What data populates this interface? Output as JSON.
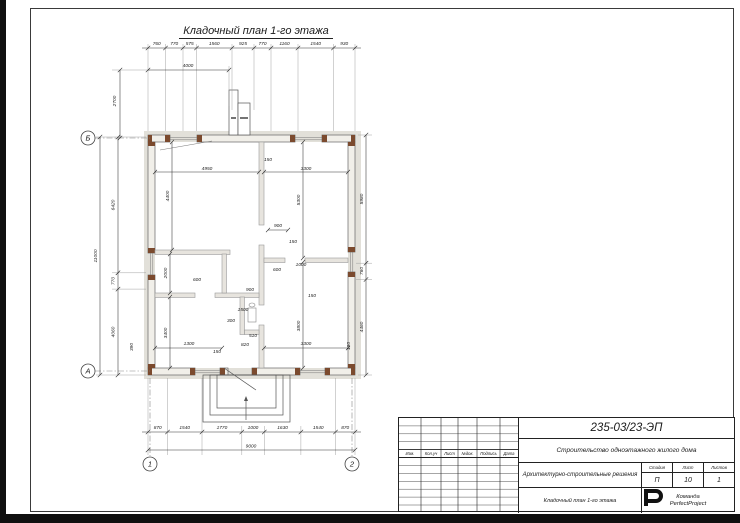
{
  "page": {
    "title": "Кладочный план 1-го этажа"
  },
  "plan": {
    "axis_markers": {
      "b": "Б",
      "a": "А",
      "n1": "1",
      "n2": "2"
    },
    "dims": {
      "top": [
        "760",
        "770",
        "575",
        "1560",
        "925",
        "770",
        "1160",
        "1540",
        "930"
      ],
      "top_secondary": "4000",
      "left_upper": "2700",
      "left": [
        "6420",
        "770",
        "4060"
      ],
      "left_overall": "11000",
      "left_small": "390",
      "right": [
        "5980",
        "760",
        "4460"
      ],
      "right_small": "180",
      "bottom": [
        "870",
        "1540",
        "1770",
        "1000",
        "1630",
        "1540",
        "870"
      ],
      "bottom_overall": "9000"
    },
    "interior": {
      "room_tl_width": "4950",
      "room_tl_height": "4400",
      "room_tr_width": "3300",
      "room_tr_height": "5300",
      "partition_top": "150",
      "door_right": "900",
      "partition_right": "150",
      "closet_height": "2000",
      "closet_width": "600",
      "hall_door": "900",
      "room_bl_height": "3400",
      "room_bl_width": "1300",
      "partition_bl": "150",
      "hall_width": "1500",
      "hall_depth": "300",
      "wc_width": "510",
      "wc_depth": "820",
      "room_br_width": "3300",
      "room_br_height": "3800",
      "niche_width": "600",
      "niche_depth": "1000",
      "partition_br": "150"
    }
  },
  "stamp": {
    "doc_number": "235-03/23-ЭП",
    "project_name": "Строительство одноэтажного жилого дома",
    "section_name": "Архитектурно-строительные решения",
    "sheet_name": "Кладочный план 1-го этажа",
    "columns": [
      "Изм.",
      "Кол.уч",
      "Лист",
      "№док.",
      "Подпись",
      "Дата"
    ],
    "stage_label": "Стадия",
    "sheet_label": "Лист",
    "sheets_label": "Листов",
    "stage_value": "П",
    "sheet_value": "10",
    "sheets_value": "1",
    "company_line1": "Команда",
    "company_line2": "PerfectProject"
  },
  "colors": {
    "lintel_brown": "#7b4a2e",
    "wall_fill": "#f1efe9",
    "outer_band": "#e2e0d9",
    "line": "#333333"
  }
}
